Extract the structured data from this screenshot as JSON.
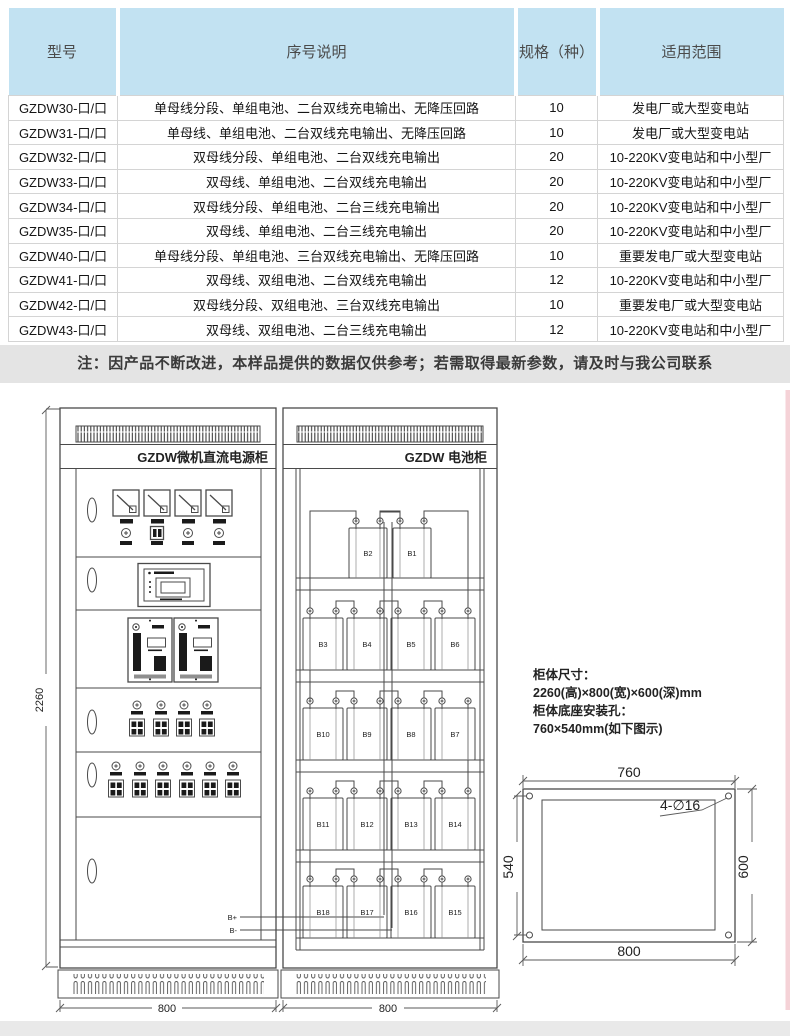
{
  "table": {
    "headers": [
      "型号",
      "序号说明",
      "规格（种）",
      "适用范围"
    ],
    "rows": [
      [
        "GZDW30-口/口",
        "单母线分段、单组电池、二台双线充电输出、无降压回路",
        "10",
        "发电厂或大型变电站"
      ],
      [
        "GZDW31-口/口",
        "单母线、单组电池、二台双线充电输出、无降压回路",
        "10",
        "发电厂或大型变电站"
      ],
      [
        "GZDW32-口/口",
        "双母线分段、单组电池、二台双线充电输出",
        "20",
        "10-220KV变电站和中小型厂"
      ],
      [
        "GZDW33-口/口",
        "双母线、单组电池、二台双线充电输出",
        "20",
        "10-220KV变电站和中小型厂"
      ],
      [
        "GZDW34-口/口",
        "双母线分段、单组电池、二台三线充电输出",
        "20",
        "10-220KV变电站和中小型厂"
      ],
      [
        "GZDW35-口/口",
        "双母线、单组电池、二台三线充电输出",
        "20",
        "10-220KV变电站和中小型厂"
      ],
      [
        "GZDW40-口/口",
        "单母线分段、单组电池、三台双线充电输出、无降压回路",
        "10",
        "重要发电厂或大型变电站"
      ],
      [
        "GZDW41-口/口",
        "双母线、双组电池、二台双线充电输出",
        "12",
        "10-220KV变电站和中小型厂"
      ],
      [
        "GZDW42-口/口",
        "双母线分段、双组电池、三台双线充电输出",
        "10",
        "重要发电厂或大型变电站"
      ],
      [
        "GZDW43-口/口",
        "双母线、双组电池、二台三线充电输出",
        "12",
        "10-220KV变电站和中小型厂"
      ]
    ]
  },
  "note": "注：因产品不断改进，本样品提供的数据仅供参考；若需取得最新参数，请及时与我公司联系",
  "drawing": {
    "power_cabinet": {
      "title": "GZDW微机直流电源柜",
      "dims": {
        "height": "2260",
        "width": "800"
      },
      "bplus_label": "B+",
      "bminus_label": "B-"
    },
    "battery_cabinet": {
      "title": "GZDW 电池柜",
      "dims": {
        "width": "800"
      },
      "shelves": [
        [
          "B2",
          "B1"
        ],
        [
          "B3",
          "B4",
          "B5",
          "B6"
        ],
        [
          "B10",
          "B9",
          "B8",
          "B7"
        ],
        [
          "B11",
          "B12",
          "B13",
          "B14"
        ],
        [
          "B18",
          "B17",
          "B16",
          "B15"
        ]
      ]
    },
    "specs": {
      "line1": "柜体尺寸：",
      "line2": "2260(高)×800(宽)×600(深)mm",
      "line3": "柜体底座安装孔：",
      "line4": "760×540mm(如下图示)"
    },
    "base_diagram": {
      "top_dim": "760",
      "bottom_dim": "800",
      "left_dim": "540",
      "right_dim": "600",
      "holes_label": "4-∅16"
    }
  },
  "colors": {
    "header_bg": "#c2e2f2",
    "note_bg": "#e4e4e4",
    "line": "#4a4a4a"
  }
}
